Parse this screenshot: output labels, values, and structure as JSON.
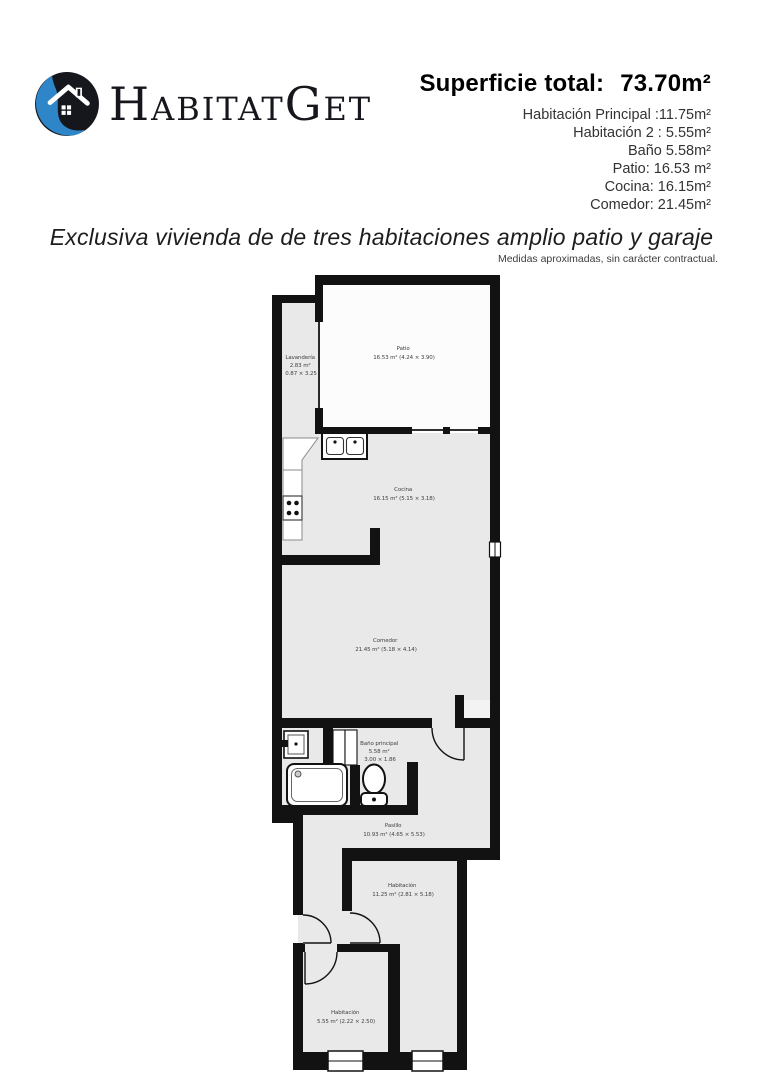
{
  "header": {
    "logo": {
      "parts": [
        "H",
        "ABITAT",
        "G",
        "ET"
      ],
      "icon": "house-logo-icon",
      "accent_blue": "#2e86c8",
      "brand_dark": "#16161d"
    },
    "summary": {
      "title_label": "Superficie total:",
      "title_value": "73.70m²",
      "lines": [
        "Habitación  Principal :11.75m²",
        "Habitación 2 : 5.55m²",
        "Baño 5.58m²",
        "Patio: 16.53 m²",
        "Cocina: 16.15m²",
        "Comedor: 21.45m²"
      ]
    }
  },
  "tagline": "Exclusiva vivienda de de tres habitaciones amplio patio y garaje",
  "disclaimer": "Medidas aproximadas, sin carácter contractual.",
  "floorplan": {
    "wall_color": "#121212",
    "floor_color": "#e9e9e9",
    "patio_floor_color": "#fcfcfc",
    "rooms": [
      {
        "id": "lavanderia",
        "lines": [
          "Lavandería",
          "2.83 m²",
          "0.87 × 3.25"
        ]
      },
      {
        "id": "patio",
        "lines": [
          "Patio",
          "16.53 m² (4.24 × 3.90)"
        ]
      },
      {
        "id": "cocina",
        "lines": [
          "Cocina",
          "16.15 m² (5.15 × 3.18)"
        ]
      },
      {
        "id": "comedor",
        "lines": [
          "Comedor",
          "21.45 m² (5.18 × 4.14)"
        ]
      },
      {
        "id": "bano",
        "lines": [
          "Baño principal",
          "5.58 m²",
          "3.00 × 1.86"
        ]
      },
      {
        "id": "pasillo",
        "lines": [
          "Pasillo",
          "10.93 m² (4.65 × 5.53)"
        ]
      },
      {
        "id": "habitacion1",
        "lines": [
          "Habitación",
          "11.25 m² (2.81 × 5.18)"
        ]
      },
      {
        "id": "habitacion2",
        "lines": [
          "Habitación",
          "5.55 m² (2.22 × 2.50)"
        ]
      }
    ]
  }
}
